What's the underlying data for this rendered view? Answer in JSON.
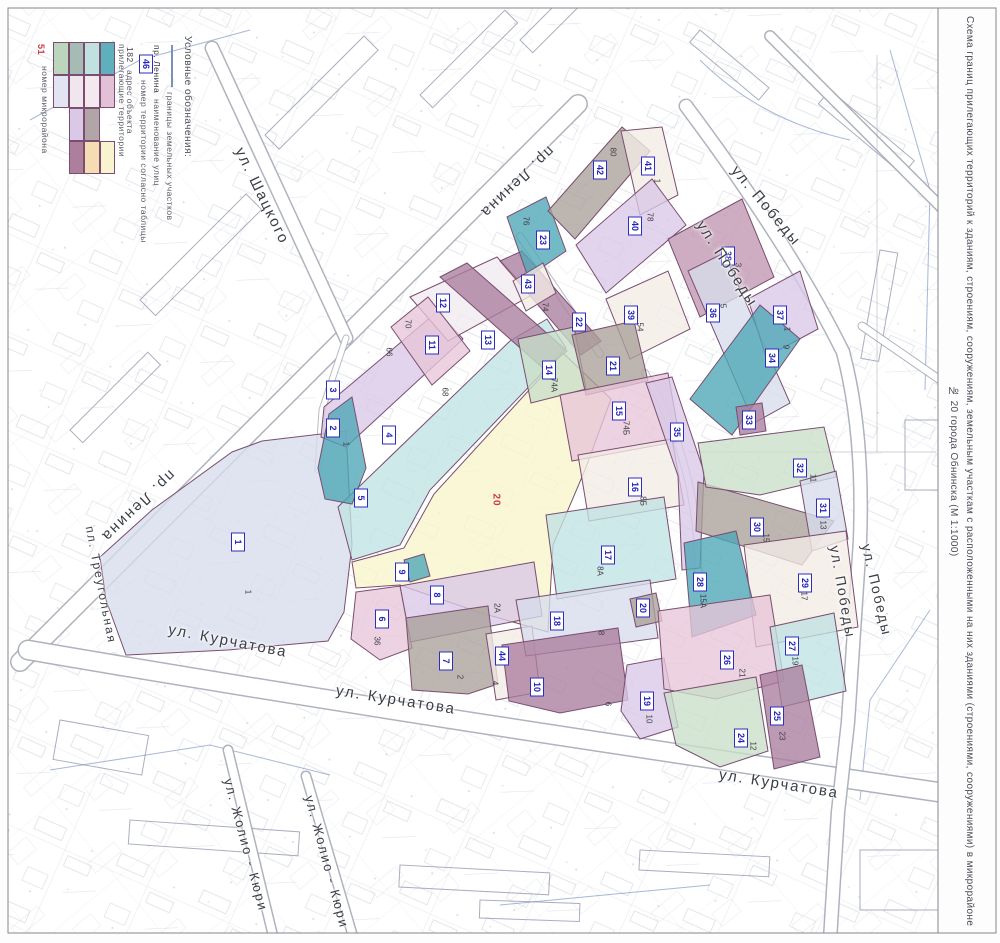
{
  "sheet": {
    "title_line1": "Схема границ прилегающих территорий к зданиям, строениям, сооружениям, земельным участкам с расположенными на них зданиями (строениями, сооружениями) в микрорайоне",
    "title_line2": "№ 20 города Обнинска (М 1:1000)"
  },
  "legend": {
    "title": "Условные обозначения:",
    "boundary_label": "границы земельных участков",
    "street_symbol": "пр. Ленина",
    "street_label": "наименование улиц",
    "territory_symbol": "46",
    "territory_label": "номер территории согласно таблицы",
    "address_symbol": "182",
    "address_label": "адрес объекта",
    "adjacent_label": "прилегающие территории",
    "district_symbol": "51",
    "district_label": "номер микрорайона",
    "grid": [
      [
        "#bcd6bd",
        "#a6bbb3",
        "#c0e1e0",
        "#5fb0bd"
      ],
      [
        "#e2e5f1",
        "#efe7ed",
        "#f3e9ef",
        "#e2c1d6"
      ],
      [
        null,
        "#d9c9e6",
        "#b2a5a8",
        null
      ],
      [
        null,
        "#ad7f9d",
        "#f6dcb2",
        "#f8f4cf"
      ]
    ]
  },
  "district_number": {
    "text": "20",
    "x": 496,
    "y": 500
  },
  "palette": {
    "teal": "#4da6b6",
    "cyan": "#c0e3e3",
    "green": "#c9dfc9",
    "yellow": "#f8f5cb",
    "cream": "#f3ece5",
    "pink": "#e8c5d8",
    "pearl": "#f1eaf0",
    "purple": "#d9c8e7",
    "bluegray": "#d7dcec",
    "taupe": "#aba09a",
    "mauve": "#aa7e9d",
    "mauve2": "#c096b1"
  },
  "streets": [
    {
      "name": "ул. Шацкого",
      "x": 262,
      "y": 196,
      "rot": 64,
      "size": 15
    },
    {
      "name": "пр. Ленина",
      "x": 517,
      "y": 182,
      "rot": 136,
      "size": 15
    },
    {
      "name": "пр. Ленина",
      "x": 138,
      "y": 506,
      "rot": 136,
      "size": 15
    },
    {
      "name": "пл. Треугольная",
      "x": 101,
      "y": 585,
      "rot": 79,
      "size": 12
    },
    {
      "name": "ул. Курчатова",
      "x": 228,
      "y": 641,
      "rot": 11,
      "size": 15
    },
    {
      "name": "ул. Курчатова",
      "x": 396,
      "y": 700,
      "rot": 9,
      "size": 15
    },
    {
      "name": "ул. Курчатова",
      "x": 779,
      "y": 784,
      "rot": 9,
      "size": 15
    },
    {
      "name": "ул. Победы",
      "x": 766,
      "y": 206,
      "rot": 50,
      "size": 15
    },
    {
      "name": "ул. Победы",
      "x": 727,
      "y": 264,
      "rot": 57,
      "size": 15
    },
    {
      "name": "ул. Победы",
      "x": 843,
      "y": 592,
      "rot": 80,
      "size": 14
    },
    {
      "name": "ул. Победы",
      "x": 877,
      "y": 590,
      "rot": 77,
      "size": 14
    },
    {
      "name": "ул. Жолио - Кюри",
      "x": 246,
      "y": 845,
      "rot": 75,
      "size": 13
    },
    {
      "name": "ул. Жолио - Кюри",
      "x": 327,
      "y": 862,
      "rot": 75,
      "size": 13
    }
  ],
  "parcels": [
    {
      "n": "1",
      "c": "bluegray",
      "pts": "100,557 152,510 232,452 262,441 346,431 352,545 344,612 328,641 228,650 126,655 106,600",
      "lx": 238,
      "ly": 542,
      "a": "1",
      "ax": 248,
      "ay": 592
    },
    {
      "n": "5",
      "c": "yellow",
      "pts": "352,562 404,548 434,494 563,353 611,399 585,470 553,545 548,632 478,612 400,585 356,588",
      "lx": 361,
      "ly": 498
    },
    {
      "n": "4",
      "c": "cyan",
      "pts": "338,507 510,341 547,319 566,348 430,490 400,545 352,560",
      "lx": 389,
      "ly": 435,
      "a": "68",
      "ax": 445,
      "ay": 392
    },
    {
      "n": "3",
      "c": "purple",
      "pts": "324,407 438,311 463,339 346,447 321,437",
      "lx": 333,
      "ly": 390,
      "a": "66",
      "ax": 389,
      "ay": 352
    },
    {
      "n": "2",
      "c": "teal",
      "pts": "318,468 329,414 352,397 366,468 352,504 325,499",
      "lx": 333,
      "ly": 428,
      "a": "1",
      "ax": 346,
      "ay": 444
    },
    {
      "n": "12",
      "c": "pearl",
      "pts": "410,297 497,257 532,295 448,341",
      "lx": 443,
      "ly": 303
    },
    {
      "n": "11",
      "c": "pink",
      "pts": "391,327 428,297 470,351 432,385",
      "lx": 432,
      "ly": 345,
      "a": "70",
      "ax": 408,
      "ay": 324
    },
    {
      "n": "13",
      "c": "mauve",
      "pts": "440,277 467,263 567,351 544,369",
      "lx": 488,
      "ly": 340
    },
    {
      "n": "22",
      "c": "mauve",
      "pts": "500,261 522,251 601,341 581,355",
      "lx": 579,
      "ly": 322,
      "a": "74",
      "ax": 545,
      "ay": 307
    },
    {
      "n": "23",
      "c": "teal",
      "pts": "507,217 546,197 566,251 528,277",
      "lx": 543,
      "ly": 240,
      "a": "76",
      "ax": 526,
      "ay": 221
    },
    {
      "n": "43",
      "c": "cream",
      "pts": "513,281 543,263 556,293 526,311",
      "lx": 528,
      "ly": 284
    },
    {
      "n": "42",
      "c": "taupe",
      "pts": "548,211 622,127 650,151 575,239",
      "lx": 600,
      "ly": 170,
      "a": "80",
      "ax": 613,
      "ay": 152
    },
    {
      "n": "41",
      "c": "cream",
      "pts": "621,131 662,127 678,195 640,215",
      "lx": 648,
      "ly": 166,
      "a": "1",
      "ax": 657,
      "ay": 181
    },
    {
      "n": "40",
      "c": "purple",
      "pts": "576,245 652,179 686,225 606,293",
      "lx": 635,
      "ly": 226,
      "a": "78",
      "ax": 650,
      "ay": 217
    },
    {
      "n": "38",
      "c": "mauve2",
      "pts": "668,239 742,199 774,277 700,317",
      "lx": 728,
      "ly": 256,
      "a": "3",
      "ax": 738,
      "ay": 265
    },
    {
      "n": "39",
      "c": "cream",
      "pts": "606,299 668,271 690,329 630,359",
      "lx": 631,
      "ly": 315,
      "a": "54",
      "ax": 640,
      "ay": 327
    },
    {
      "n": "36",
      "c": "bluegray",
      "pts": "688,271 724,253 790,403 754,423",
      "lx": 713,
      "ly": 313,
      "a": "5",
      "ax": 723,
      "ay": 306
    },
    {
      "n": "37",
      "c": "purple",
      "pts": "748,299 800,271 818,329 766,357",
      "lx": 780,
      "ly": 315,
      "a": "1",
      "ax": 787,
      "ay": 329
    },
    {
      "n": "34",
      "c": "teal",
      "pts": "690,399 760,305 800,339 732,435",
      "lx": 772,
      "ly": 358,
      "a": "9",
      "ax": 786,
      "ay": 347
    },
    {
      "n": "33",
      "c": "mauve",
      "pts": "736,407 762,403 766,431 740,435",
      "lx": 749,
      "ly": 420
    },
    {
      "n": "14",
      "c": "green",
      "pts": "518,339 574,327 586,389 531,403",
      "lx": 549,
      "ly": 370,
      "a": "74А",
      "ax": 554,
      "ay": 385
    },
    {
      "n": "21",
      "c": "taupe",
      "pts": "572,335 634,321 648,381 586,395",
      "lx": 613,
      "ly": 366
    },
    {
      "n": "15",
      "c": "pink",
      "pts": "560,395 668,373 680,441 572,461",
      "lx": 619,
      "ly": 411,
      "a": "74Б",
      "ax": 626,
      "ay": 428
    },
    {
      "n": "16",
      "c": "cream",
      "pts": "578,455 672,439 684,505 589,521",
      "lx": 635,
      "ly": 487,
      "a": "8Б",
      "ax": 643,
      "ay": 501
    },
    {
      "n": "17",
      "c": "cyan",
      "pts": "546,515 664,497 676,579 557,599",
      "lx": 608,
      "ly": 555,
      "a": "8А",
      "ax": 600,
      "ay": 571
    },
    {
      "n": "35",
      "c": "purple",
      "pts": "646,383 672,377 704,472 700,568 682,570 678,476",
      "lx": 677,
      "ly": 432
    },
    {
      "n": "8",
      "c": "purple",
      "pts": "400,586 534,562 542,616 410,642",
      "lx": 437,
      "ly": 595,
      "a": "2А",
      "ax": 497,
      "ay": 608
    },
    {
      "n": "9",
      "c": "teal",
      "pts": "404,560 424,554 430,576 410,582",
      "lx": 402,
      "ly": 572
    },
    {
      "n": "6",
      "c": "pink",
      "pts": "356,592 400,586 412,648 380,660 351,639",
      "lx": 382,
      "ly": 619,
      "a": "36",
      "ax": 377,
      "ay": 641
    },
    {
      "n": "7",
      "c": "taupe",
      "pts": "406,618 488,606 498,684 468,694 412,690",
      "lx": 446,
      "ly": 661,
      "a": "2",
      "ax": 460,
      "ay": 677
    },
    {
      "n": "44",
      "c": "cream",
      "pts": "486,634 532,626 540,692 496,700",
      "lx": 502,
      "ly": 656,
      "a": "4",
      "ax": 495,
      "ay": 683
    },
    {
      "n": "18",
      "c": "bluegray",
      "pts": "516,600 650,580 658,638 526,656",
      "lx": 557,
      "ly": 621,
      "a": "8",
      "ax": 601,
      "ay": 633
    },
    {
      "n": "10",
      "c": "mauve",
      "pts": "502,645 618,628 628,700 560,713 509,701",
      "lx": 537,
      "ly": 687,
      "a": "6",
      "ax": 608,
      "ay": 704
    },
    {
      "n": "19",
      "c": "purple",
      "pts": "627,665 664,658 678,727 640,739 621,711",
      "lx": 647,
      "ly": 701,
      "a": "10",
      "ax": 649,
      "ay": 719
    },
    {
      "n": "20",
      "c": "taupe",
      "pts": "630,599 656,593 662,621 636,627",
      "lx": 643,
      "ly": 608
    },
    {
      "n": "30",
      "c": "taupe",
      "pts": "698,482 834,521 802,565 696,531",
      "lx": 757,
      "ly": 527,
      "a": "15",
      "ax": 766,
      "ay": 538
    },
    {
      "n": "32",
      "c": "green",
      "pts": "698,443 824,427 836,477 760,495 706,487",
      "lx": 800,
      "ly": 468,
      "a": "11",
      "ax": 813,
      "ay": 478
    },
    {
      "n": "31",
      "c": "bluegray",
      "pts": "800,481 836,471 848,539 812,551",
      "lx": 823,
      "ly": 508,
      "a": "13",
      "ax": 823,
      "ay": 525
    },
    {
      "n": "29",
      "c": "cream",
      "pts": "744,545 846,531 858,627 756,647",
      "lx": 805,
      "ly": 583,
      "a": "17",
      "ax": 804,
      "ay": 596
    },
    {
      "n": "28",
      "c": "teal",
      "pts": "684,543 736,531 756,615 692,637",
      "lx": 700,
      "ly": 582,
      "a": "15А",
      "ax": 703,
      "ay": 601
    },
    {
      "n": "26",
      "c": "pink",
      "pts": "658,611 770,595 784,681 716,699 664,689",
      "lx": 727,
      "ly": 660,
      "a": "21",
      "ax": 742,
      "ay": 673
    },
    {
      "n": "27",
      "c": "cyan",
      "pts": "770,627 834,613 846,691 782,707",
      "lx": 792,
      "ly": 646,
      "a": "19",
      "ax": 795,
      "ay": 661
    },
    {
      "n": "24",
      "c": "green",
      "pts": "664,693 756,677 768,751 720,767 676,745",
      "lx": 741,
      "ly": 738,
      "a": "12",
      "ax": 753,
      "ay": 746
    },
    {
      "n": "25",
      "c": "mauve",
      "pts": "760,675 802,665 820,757 774,769",
      "lx": 777,
      "ly": 716,
      "a": "23",
      "ax": 782,
      "ay": 736
    }
  ]
}
